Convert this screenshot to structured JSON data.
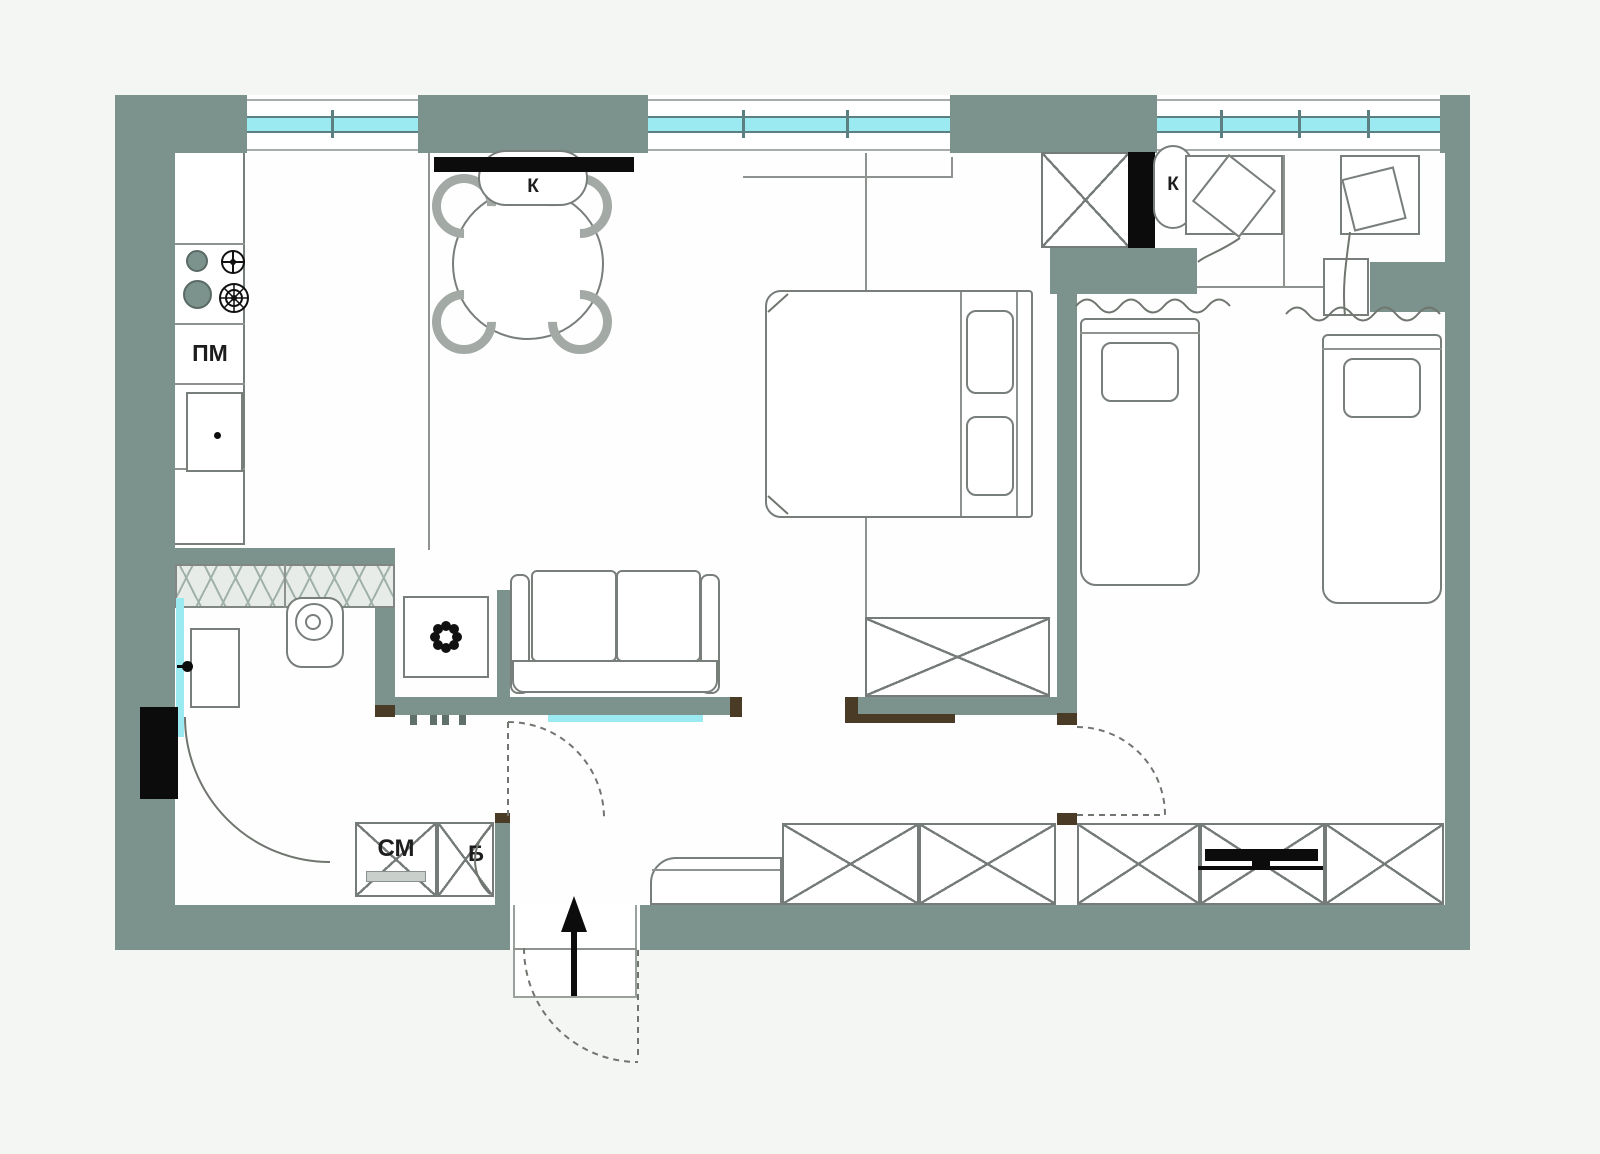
{
  "title": "apartment-floor-plan",
  "labels": {
    "dishwasher": "ПМ",
    "ac_living": "К",
    "ac_children": "К",
    "washing_machine": "СМ",
    "boiler": "Б"
  },
  "colors": {
    "wall": "#7c928c",
    "window_glass": "#9be9f1",
    "furniture_line": "#787e7a",
    "door_jamb": "#4a3b26",
    "black_elements": "#0c0c0c",
    "hatch_band": "#e7ece9",
    "floor": "#fefefe",
    "background": "#f4f6f3"
  },
  "symbols": {
    "entrance_arrow": "up-arrow",
    "plant_icon": "8-petal-flower",
    "gas_burner_icon": "spoked-circle",
    "electric_burner_icon": "filled-circle",
    "tv_icon": "black-bar",
    "wardrobe_icon": "x-cross-box",
    "door_swing_icon": "quarter-arc",
    "bed_blanket_icon": "wavy-line"
  }
}
